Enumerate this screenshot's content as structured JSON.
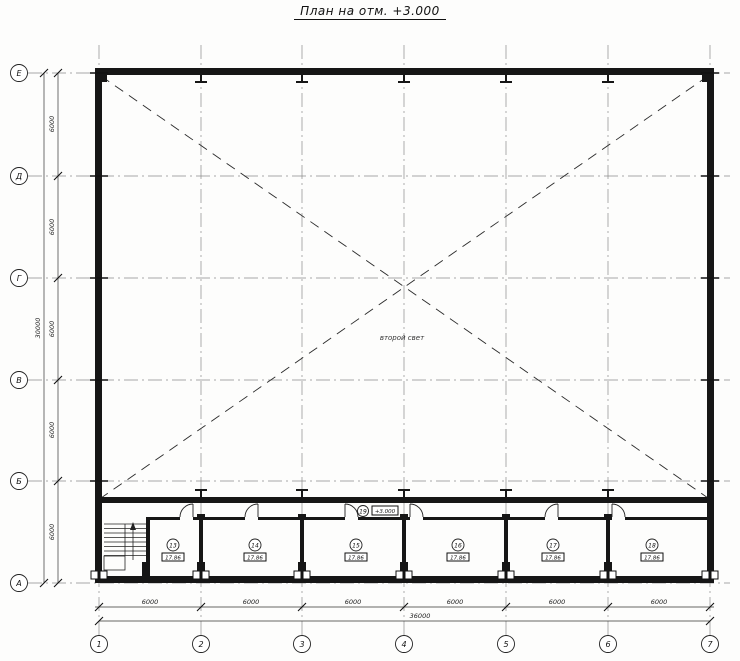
{
  "title": "План на отм. +3.000",
  "drawing": {
    "note": "второй свет",
    "axes": {
      "horizontal": [
        "Е",
        "Д",
        "Г",
        "В",
        "Б",
        "А"
      ],
      "vertical": [
        "1",
        "2",
        "3",
        "4",
        "5",
        "6",
        "7"
      ]
    },
    "dims": {
      "left": [
        "6000",
        "6000",
        "6000",
        "6000",
        "6000"
      ],
      "left_overall": "30000",
      "bottom": [
        "6000",
        "6000",
        "6000",
        "6000",
        "6000",
        "6000"
      ],
      "bottom_overall": "36000"
    },
    "corridor": {
      "number": "19",
      "label": "+3.000"
    },
    "rooms": [
      {
        "number": "13",
        "area": "17.86"
      },
      {
        "number": "14",
        "area": "17.86"
      },
      {
        "number": "15",
        "area": "17.86"
      },
      {
        "number": "16",
        "area": "17.86"
      },
      {
        "number": "17",
        "area": "17.86"
      },
      {
        "number": "18",
        "area": "17.86"
      }
    ]
  }
}
